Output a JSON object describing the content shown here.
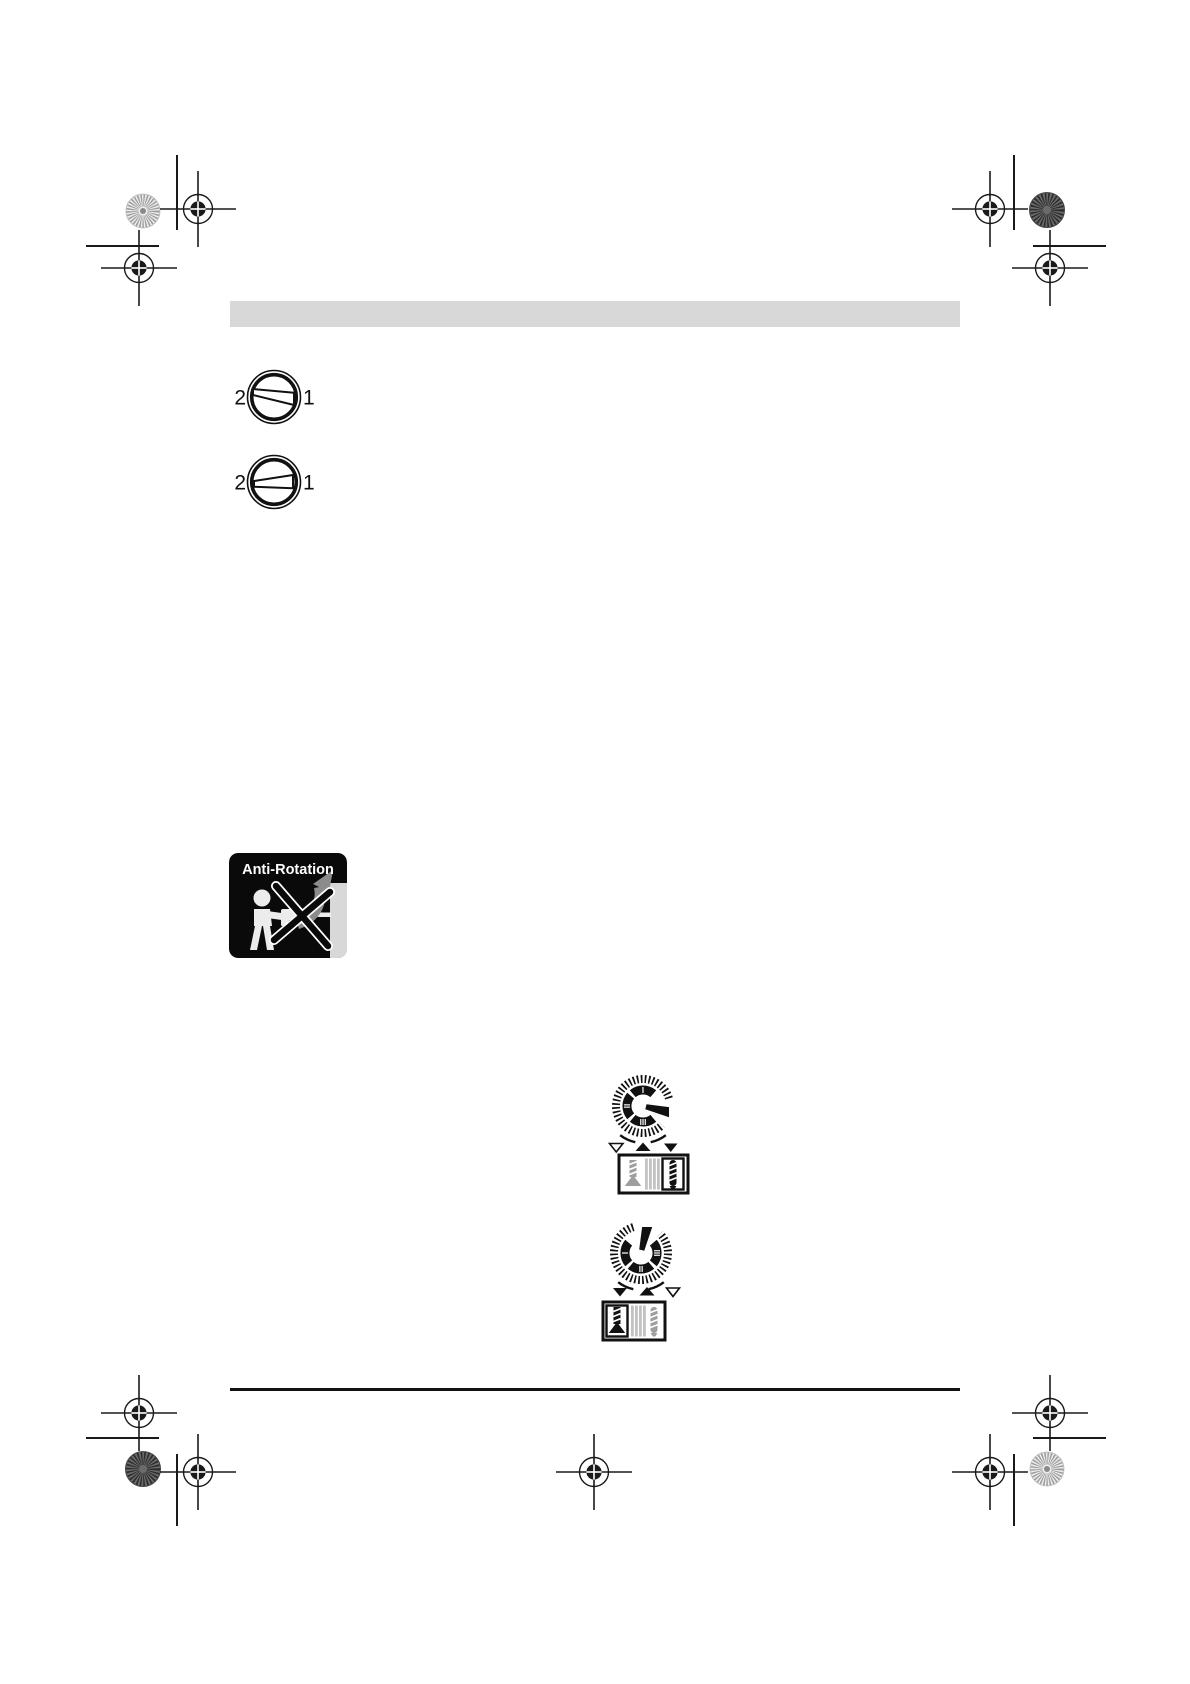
{
  "page": {
    "description": "Instruction manual page scan with print registration marks",
    "background": "#ffffff"
  },
  "header_bar": {
    "color": "#d8d8d8"
  },
  "gear_selector_icons": {
    "icon_1": {
      "left_label": "2",
      "right_label": "1"
    },
    "icon_2": {
      "left_label": "2",
      "right_label": "1"
    }
  },
  "anti_rotation_badge": {
    "title": "Anti-Rotation",
    "background": "#0a0a0a",
    "text_color": "#ffffff",
    "arrow_color": "#8c8c8c"
  },
  "mode_dials": {
    "dial_1": {
      "numeral_top": "I",
      "numeral_left": "II",
      "numeral_bottom": "III"
    },
    "dial_2": {
      "numeral_left": "I",
      "numeral_bottom": "II",
      "numeral_right": "III"
    }
  },
  "colors": {
    "ink": "#111111",
    "header_bar": "#d8d8d8",
    "inactive_icon_gray": "#9e9e9e",
    "stripe_gray": "#c2c2c2",
    "arrow_gray": "#8c8c8c"
  }
}
